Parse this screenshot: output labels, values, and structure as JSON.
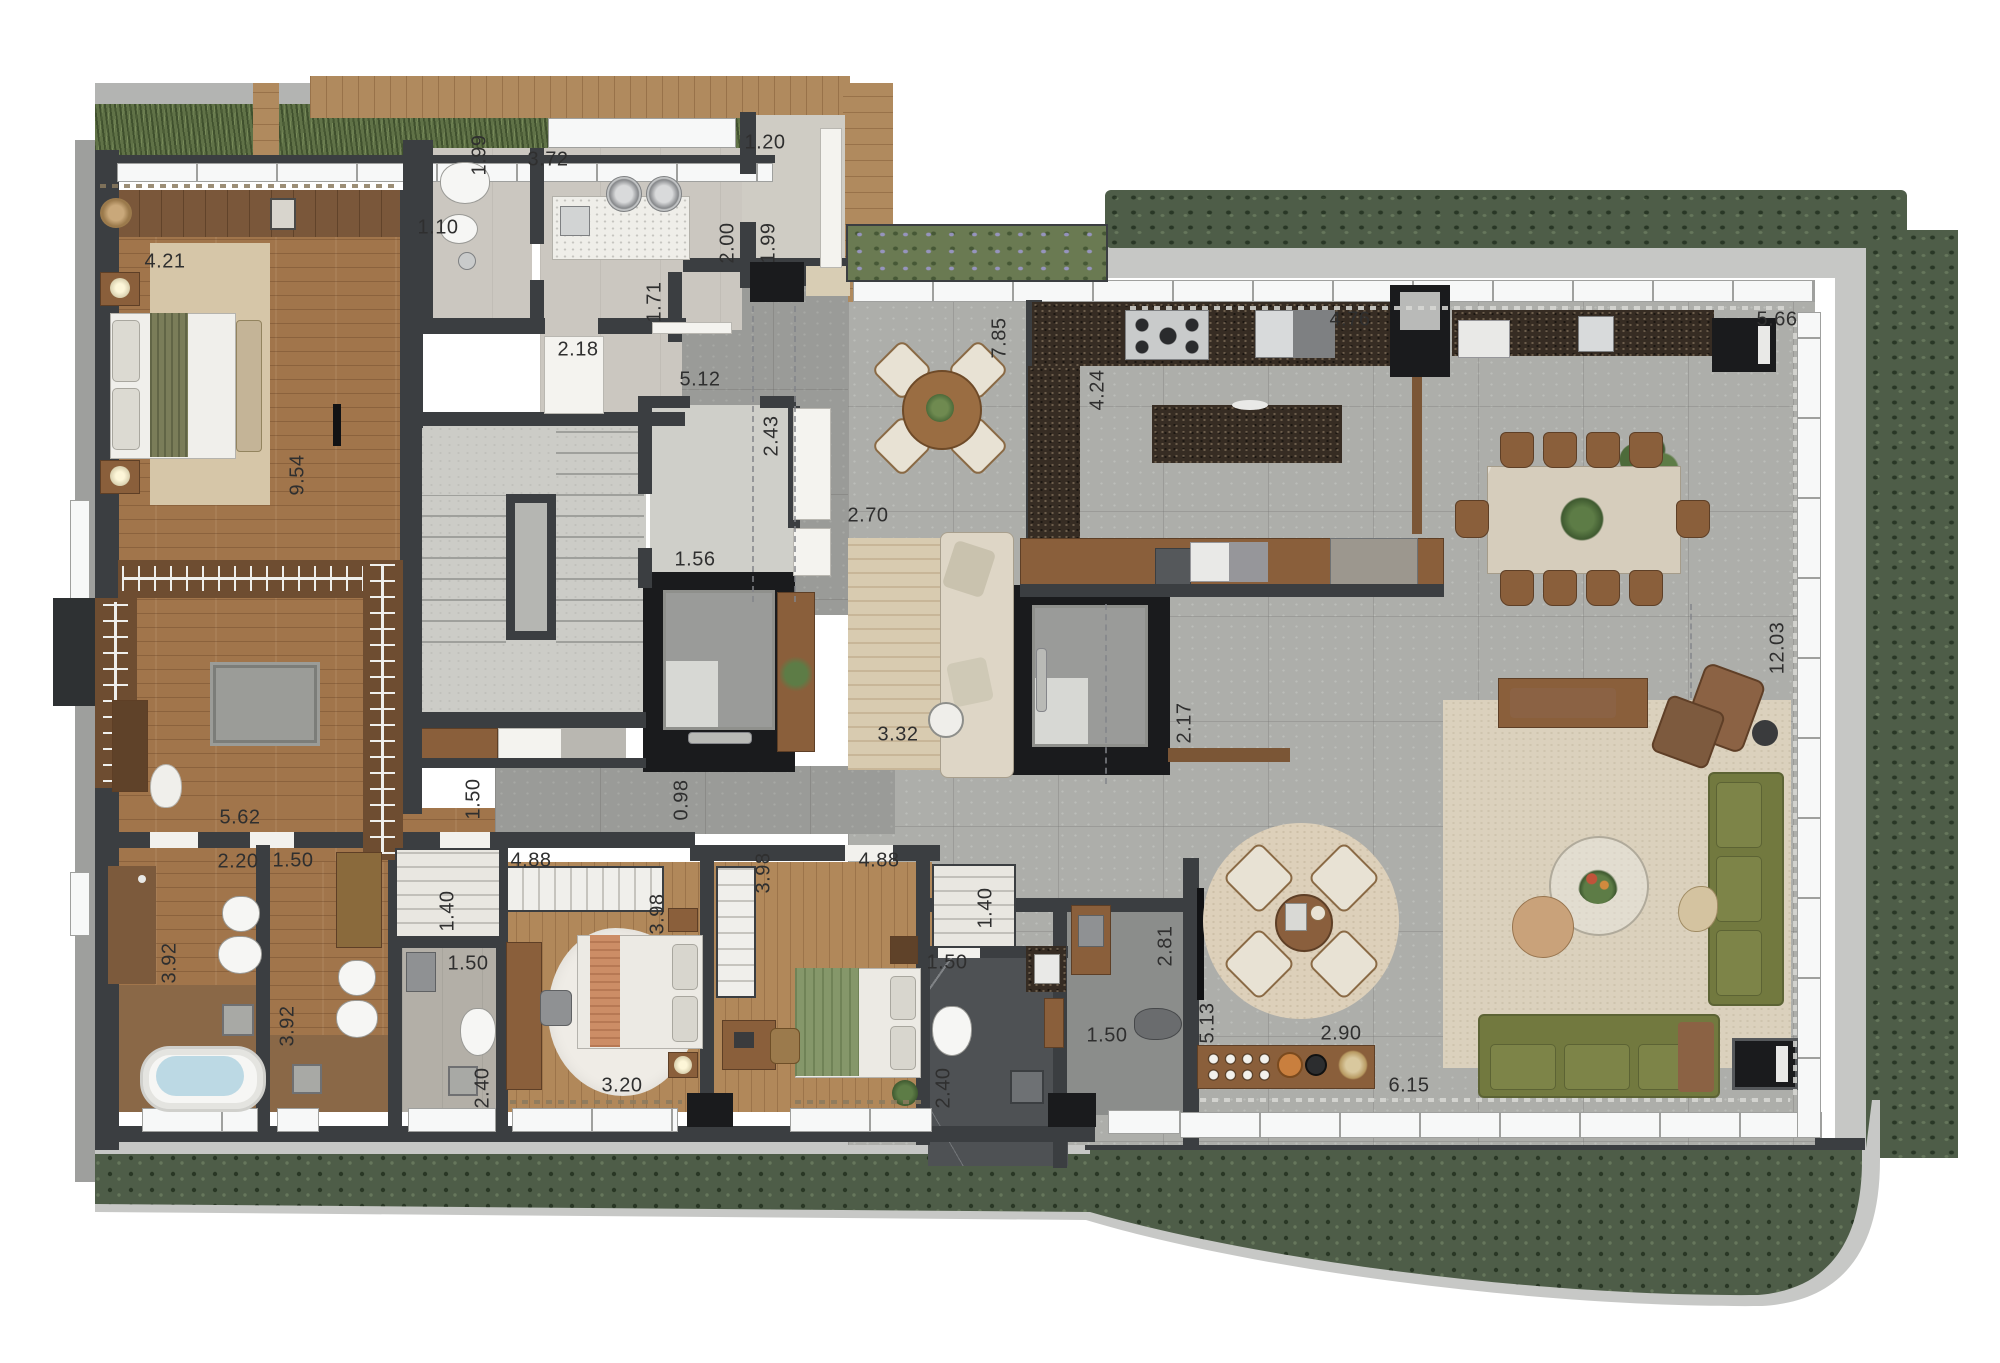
{
  "meta": {
    "type": "residential-floor-plan",
    "units": "m",
    "description": "penthouse apartment top-view render"
  },
  "palette": {
    "wall": "#3b3e41",
    "shaft": "#1a1b1d",
    "concrete_floor": "#adaeaa",
    "wood_floor": "#a1754b",
    "bedroom_wood": "#b1885a",
    "granite": "#362c23",
    "hedge_green": "#4e5d48",
    "grass_green": "#607247",
    "rug_beige": "#d8cbb0",
    "sofa_green": "#72793f",
    "leather_brown": "#8b6244",
    "dark_marble": "#4e5154",
    "window_white": "#f7f8f8",
    "label_color": "#2f2f2f"
  },
  "dimension_labels": [
    {
      "name": "master-bedroom-width",
      "text": "4.21",
      "x": 165,
      "y": 262,
      "vertical": false
    },
    {
      "name": "master-suite-depth",
      "text": "9.54",
      "x": 298,
      "y": 475,
      "vertical": true
    },
    {
      "name": "wc-depth",
      "text": "1.99",
      "x": 480,
      "y": 155,
      "vertical": true
    },
    {
      "name": "laundry-width",
      "text": "3.72",
      "x": 548,
      "y": 160,
      "vertical": false
    },
    {
      "name": "wc-width",
      "text": "1.10",
      "x": 438,
      "y": 228,
      "vertical": false
    },
    {
      "name": "storage-width",
      "text": "1.20",
      "x": 765,
      "y": 143,
      "vertical": false
    },
    {
      "name": "storage-depth-a",
      "text": "2.00",
      "x": 728,
      "y": 243,
      "vertical": true
    },
    {
      "name": "storage-depth-b",
      "text": "1.99",
      "x": 769,
      "y": 243,
      "vertical": true
    },
    {
      "name": "service-pass",
      "text": "1.71",
      "x": 655,
      "y": 302,
      "vertical": true
    },
    {
      "name": "service-width",
      "text": "2.18",
      "x": 578,
      "y": 350,
      "vertical": false
    },
    {
      "name": "hall-length",
      "text": "5.12",
      "x": 700,
      "y": 380,
      "vertical": false
    },
    {
      "name": "lobby-depth",
      "text": "2.43",
      "x": 772,
      "y": 436,
      "vertical": true
    },
    {
      "name": "elevator-hall-width",
      "text": "1.56",
      "x": 695,
      "y": 560,
      "vertical": false
    },
    {
      "name": "foyer-width",
      "text": "2.70",
      "x": 868,
      "y": 516,
      "vertical": false
    },
    {
      "name": "terrace-depth",
      "text": "7.85",
      "x": 1000,
      "y": 338,
      "vertical": true
    },
    {
      "name": "kitchen-depth",
      "text": "4.24",
      "x": 1098,
      "y": 390,
      "vertical": true
    },
    {
      "name": "kitchen-width",
      "text": "4.76",
      "x": 1350,
      "y": 320,
      "vertical": false
    },
    {
      "name": "gourmet-width",
      "text": "5.66",
      "x": 1777,
      "y": 320,
      "vertical": false
    },
    {
      "name": "foyer-rug-length",
      "text": "3.32",
      "x": 898,
      "y": 735,
      "vertical": false
    },
    {
      "name": "elevator2-width",
      "text": "2.17",
      "x": 1185,
      "y": 723,
      "vertical": true
    },
    {
      "name": "living-depth",
      "text": "12.03",
      "x": 1778,
      "y": 648,
      "vertical": true
    },
    {
      "name": "closet-corridor-length",
      "text": "5.62",
      "x": 240,
      "y": 818,
      "vertical": false
    },
    {
      "name": "corridor-a-width",
      "text": "1.50",
      "x": 474,
      "y": 799,
      "vertical": true
    },
    {
      "name": "corridor-b-width",
      "text": "0.98",
      "x": 682,
      "y": 800,
      "vertical": true
    },
    {
      "name": "master-bath-width",
      "text": "2.20",
      "x": 238,
      "y": 862,
      "vertical": false
    },
    {
      "name": "bath2-width",
      "text": "1.50",
      "x": 293,
      "y": 861,
      "vertical": false
    },
    {
      "name": "master-bath-depth",
      "text": "3.92",
      "x": 170,
      "y": 963,
      "vertical": true
    },
    {
      "name": "bath2-depth",
      "text": "3.92",
      "x": 288,
      "y": 1026,
      "vertical": true
    },
    {
      "name": "closet2-depth",
      "text": "1.40",
      "x": 448,
      "y": 911,
      "vertical": true
    },
    {
      "name": "bath3-width",
      "text": "1.50",
      "x": 468,
      "y": 964,
      "vertical": false
    },
    {
      "name": "bath3-depth",
      "text": "2.40",
      "x": 483,
      "y": 1088,
      "vertical": true
    },
    {
      "name": "bedroom2-width",
      "text": "4.88",
      "x": 531,
      "y": 861,
      "vertical": false
    },
    {
      "name": "bedroom2-depth",
      "text": "3.98",
      "x": 658,
      "y": 914,
      "vertical": true
    },
    {
      "name": "bedroom2-bed-span",
      "text": "3.20",
      "x": 622,
      "y": 1086,
      "vertical": false
    },
    {
      "name": "bedroom3-depth",
      "text": "3.98",
      "x": 764,
      "y": 873,
      "vertical": true
    },
    {
      "name": "bedroom3-width",
      "text": "4.88",
      "x": 879,
      "y": 861,
      "vertical": false
    },
    {
      "name": "closet3-depth",
      "text": "1.40",
      "x": 986,
      "y": 908,
      "vertical": true
    },
    {
      "name": "bath4-width",
      "text": "1.50",
      "x": 947,
      "y": 963,
      "vertical": false
    },
    {
      "name": "bath4-depth",
      "text": "2.40",
      "x": 944,
      "y": 1088,
      "vertical": true
    },
    {
      "name": "powder-width",
      "text": "1.50",
      "x": 1107,
      "y": 1036,
      "vertical": false
    },
    {
      "name": "powder-corridor",
      "text": "2.81",
      "x": 1166,
      "y": 946,
      "vertical": true
    },
    {
      "name": "lounge-depth",
      "text": "5.13",
      "x": 1208,
      "y": 1023,
      "vertical": true
    },
    {
      "name": "coffee-bar-width",
      "text": "2.90",
      "x": 1341,
      "y": 1034,
      "vertical": false
    },
    {
      "name": "living-width",
      "text": "6.15",
      "x": 1409,
      "y": 1086,
      "vertical": false
    }
  ]
}
